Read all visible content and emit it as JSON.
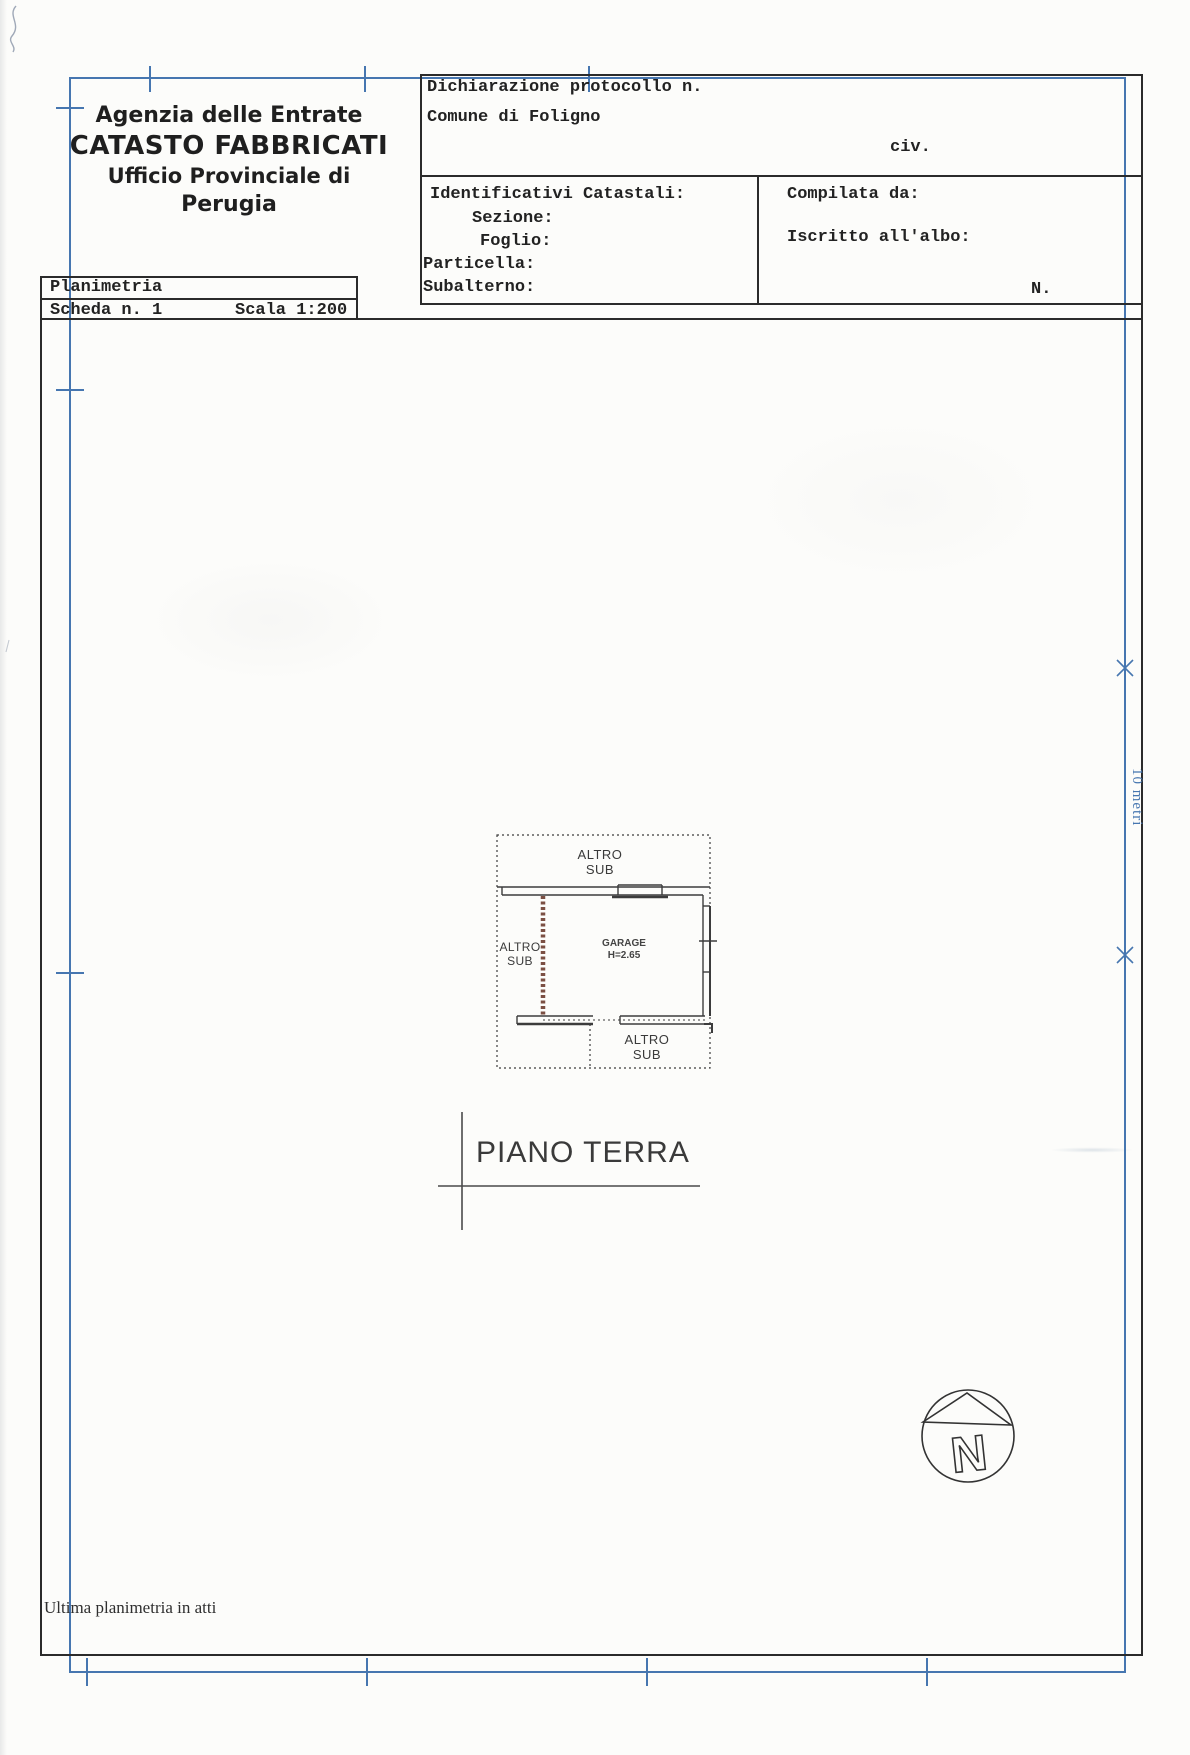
{
  "agency": {
    "line1": "Agenzia delle Entrate",
    "line2": "CATASTO FABBRICATI",
    "line3": "Ufficio Provinciale di",
    "line4": "Perugia"
  },
  "plan_card": {
    "title": "Planimetria",
    "sheet": "Scheda n. 1",
    "scale": "Scala 1:200"
  },
  "declaration": {
    "protocol_label": "Dichiarazione protocollo n.",
    "comune": "Comune di Foligno",
    "civ_label": "civ."
  },
  "cadastral": {
    "title": "Identificativi Catastali:",
    "sezione": "Sezione:",
    "foglio": "Foglio:",
    "particella": "Particella:",
    "subalterno": "Subalterno:"
  },
  "compiler": {
    "compilata": "Compilata da:",
    "iscritto": "Iscritto all'albo:",
    "number_label": "N."
  },
  "floorplan": {
    "altro_sub_top": "ALTRO\nSUB",
    "altro_sub_left": "ALTRO\nSUB",
    "altro_sub_bottom": "ALTRO\nSUB",
    "garage": "GARAGE\nH=2.65",
    "floor_title": "PIANO TERRA"
  },
  "scale_bar": {
    "label": "10 metri"
  },
  "north": {
    "letter": "N"
  },
  "footer": {
    "note": "Ultima planimetria in atti"
  },
  "colors": {
    "frame_blue": "#4676b0",
    "ink": "#2b2b2b",
    "wall_brown": "#7b4f43"
  }
}
